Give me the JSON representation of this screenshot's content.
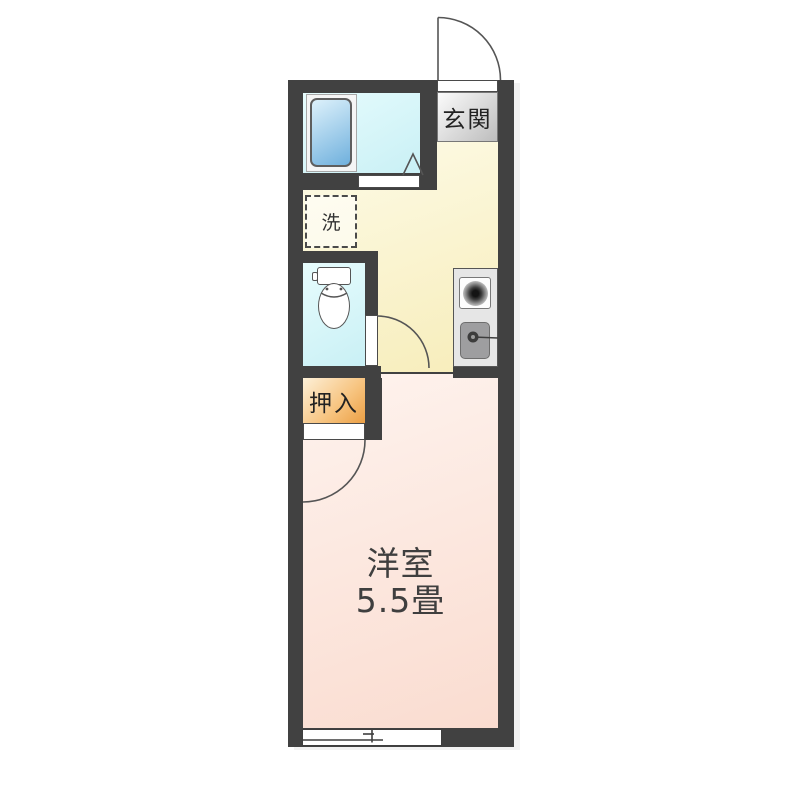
{
  "floorplan": {
    "rooms": {
      "entrance": {
        "label": "玄関"
      },
      "laundry": {
        "label": "洗"
      },
      "closet": {
        "label": "押入"
      },
      "western_room": {
        "label": "洋室",
        "size": "5.5畳"
      }
    },
    "colors": {
      "wall": "#414141",
      "line": "#555555",
      "floor_hall_1": "#fefdee",
      "floor_hall_2": "#f7edba",
      "floor_bath_1": "#e7fcfd",
      "floor_bath_2": "#c9f0f5",
      "floor_room_1": "#fef3ee",
      "floor_room_2": "#fadcd0",
      "closet_1": "#fdf0d8",
      "closet_2": "#eb9f44",
      "entrance_label_1": "#fbfbfb",
      "entrance_label_2": "#bdbdbd",
      "tub_1": "#ddf1fb",
      "tub_2": "#6fb0dd",
      "unit_bg": "#e6e6e6",
      "sink_bg": "#9e9ea0"
    }
  }
}
